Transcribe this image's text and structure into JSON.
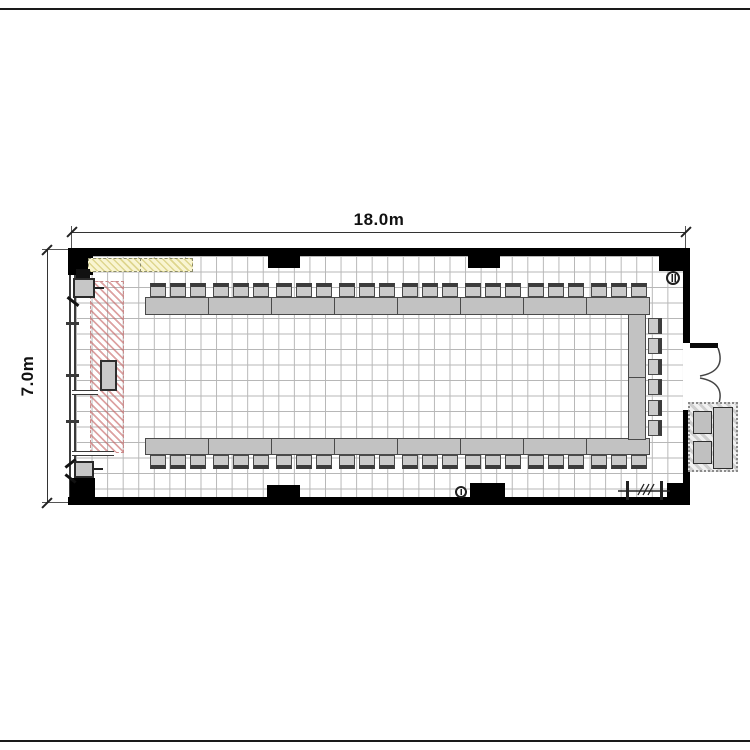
{
  "drawing": {
    "type": "floor-plan",
    "dimensions": {
      "width_label": "18.0m",
      "height_label": "7.0m",
      "width_m": 18.0,
      "height_m": 7.0
    }
  },
  "colors": {
    "wall": "#000000",
    "table_fill": "#c2c2c2",
    "chair_fill": "#cacaca",
    "chair_back": "#3c3c3c",
    "grid_line": "#b7b7b7",
    "red_hatch": "#c66464",
    "yellow_zone_fill": "#f9f5d2",
    "dimension_text": "#111111"
  },
  "furniture": {
    "rows": [
      {
        "name": "top-table-row",
        "orient": "h",
        "back": "top",
        "tables": 8,
        "chairs_per_table": 3,
        "x": 146,
        "table_y": 297,
        "table_w": 504,
        "table_h": 18,
        "seg_w": 63,
        "chair_off": 4,
        "chair_step": 20,
        "chair_y": 283,
        "chair_w": 16,
        "chair_h": 14
      },
      {
        "name": "bottom-table-row",
        "orient": "h",
        "back": "bottom",
        "tables": 8,
        "chairs_per_table": 3,
        "x": 146,
        "table_y": 438,
        "table_w": 504,
        "table_h": 17,
        "seg_w": 63,
        "chair_off": 4,
        "chair_step": 20,
        "chair_y": 455,
        "chair_w": 16,
        "chair_h": 14
      },
      {
        "name": "right-table-column",
        "orient": "v",
        "back": "right",
        "tables": 2,
        "chairs": 6,
        "x": 628,
        "table_y": 315,
        "table_w": 18,
        "table_h": 125,
        "chair_x": 648,
        "chair_y0": 318,
        "chair_step": 20.4,
        "chair_w": 14,
        "chair_h": 16
      }
    ],
    "total_seats": 54
  },
  "symbols": [
    "fire-extinguisher-top-right",
    "fire-extinguisher-bottom-center",
    "double-swing-door-right",
    "entrance-cabinet-outside",
    "projection-screen-zone-red",
    "whiteboard-strip-yellow",
    "speaker-podium",
    "operator-desk-bottom-left",
    "av-equipment-top-left",
    "partition-symbol-bottom-right"
  ]
}
